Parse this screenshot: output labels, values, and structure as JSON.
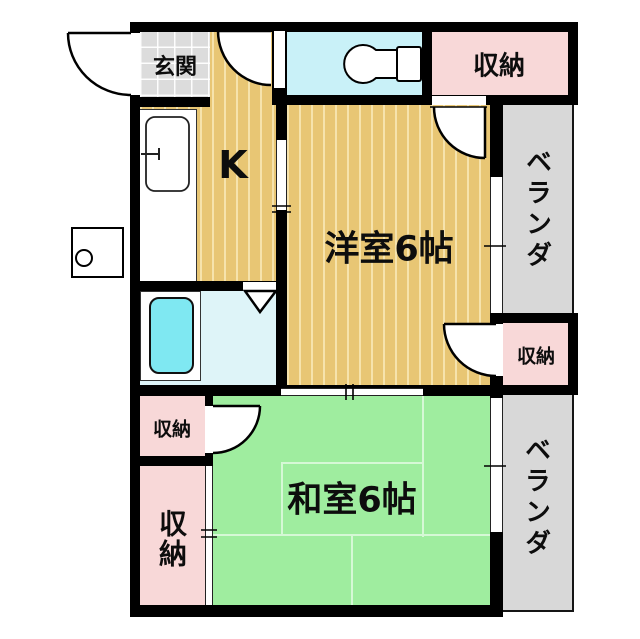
{
  "plan": {
    "title": "1K/2K apartment floor plan",
    "rooms": {
      "genkan": {
        "label": "玄関"
      },
      "kitchen": {
        "label": "K"
      },
      "western_room": {
        "label": "洋室6帖"
      },
      "japanese_room": {
        "label": "和室6帖"
      },
      "storage_top_right": {
        "label": "収納"
      },
      "storage_mid_right": {
        "label": "収納"
      },
      "storage_left_upper": {
        "label": "収納"
      },
      "storage_left_lower": {
        "label": "収納"
      },
      "veranda_upper": {
        "label": "ベランダ"
      },
      "veranda_lower": {
        "label": "ベランダ"
      }
    },
    "colors": {
      "wall": "#000000",
      "wood_floor": "#e8c674",
      "tatami_green": "#9fed9f",
      "storage_pink": "#f8d8d8",
      "toilet_cyan": "#c9f1f8",
      "bathroom_cyan": "#def4f8",
      "bathtub_cyan": "#7fe8f2",
      "veranda_gray": "#d8d8d8",
      "entrance_tile_gray": "#dcdcdc"
    }
  }
}
